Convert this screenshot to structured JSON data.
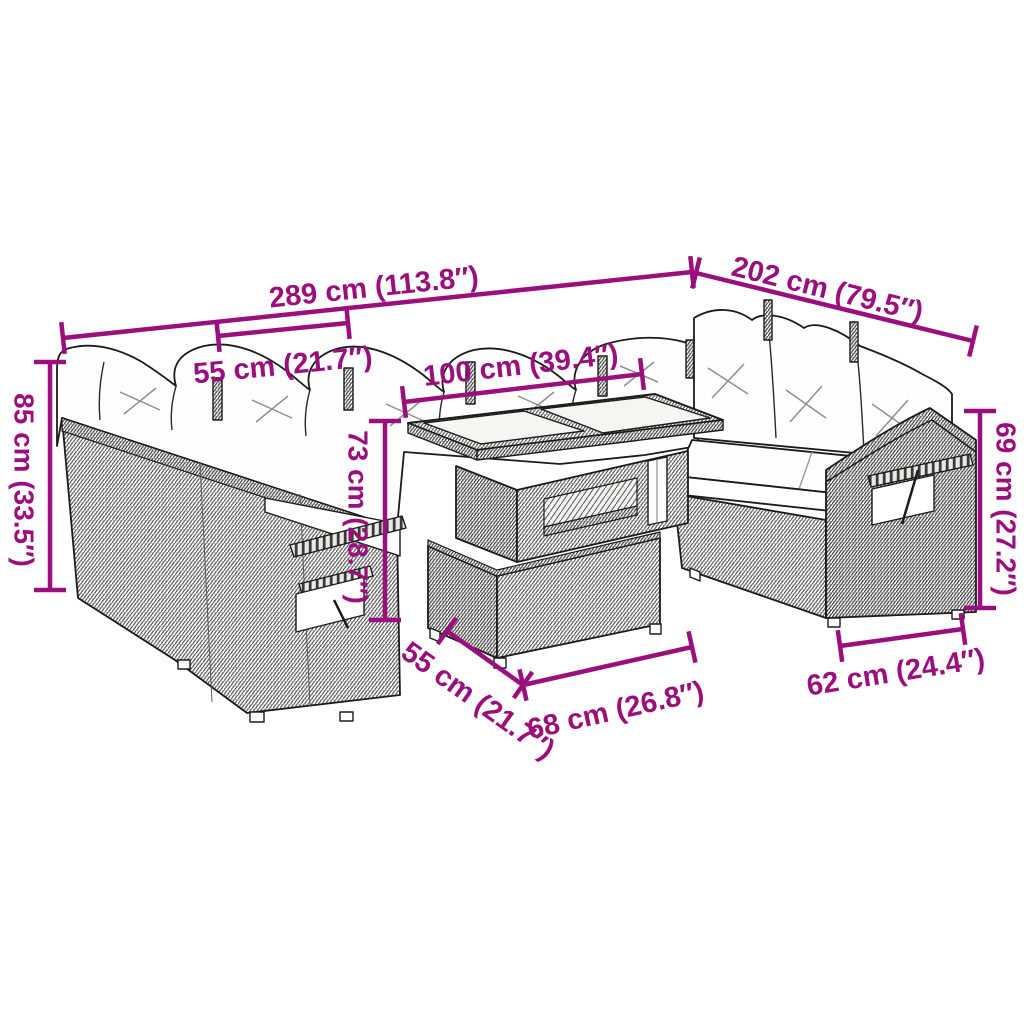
{
  "diagram": {
    "kind": "product-dimension-diagram",
    "subject": "poly-rattan garden lounge set with cushions and lift-top table"
  },
  "colors": {
    "dimension_accent": "#9b0e7e",
    "line_art": "#1b1b1b",
    "background": "#ffffff",
    "cushion": "#fefefe",
    "glass": "#f5f5f1"
  },
  "dimensions": [
    {
      "id": "total-width",
      "label": "289 cm (113.8″)"
    },
    {
      "id": "right-side-length",
      "label": "202 cm (79.5″)"
    },
    {
      "id": "seat-module-width",
      "label": "55 cm (21.7″)"
    },
    {
      "id": "table-top-width",
      "label": "100 cm (39.4″)"
    },
    {
      "id": "back-height",
      "label": "85 cm (33.5″)"
    },
    {
      "id": "table-height",
      "label": "73 cm (28.7″)"
    },
    {
      "id": "arm-height",
      "label": "69 cm (27.2″)"
    },
    {
      "id": "table-depth",
      "label": "55 cm (21.7″)"
    },
    {
      "id": "table-base-width",
      "label": "68 cm (26.8″)"
    },
    {
      "id": "seat-depth",
      "label": "62 cm (24.4″)"
    }
  ]
}
